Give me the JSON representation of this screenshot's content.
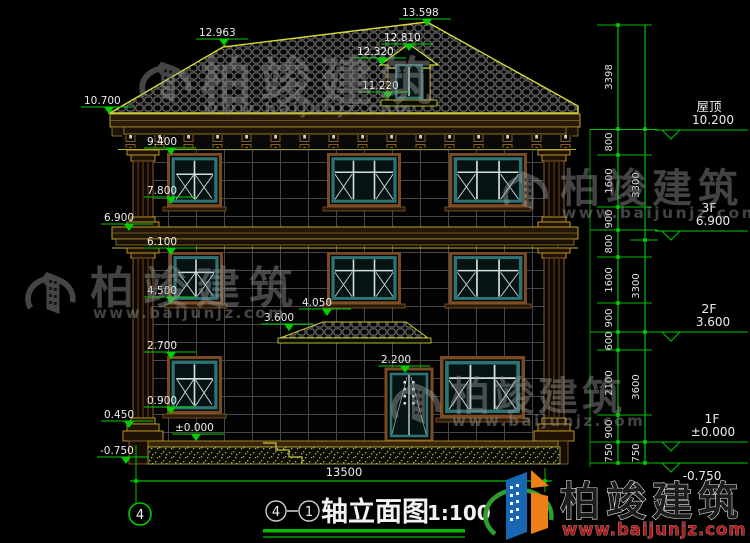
{
  "title": {
    "axis_from": "4",
    "axis_to": "1",
    "text": "轴立面图",
    "scale": "1:100"
  },
  "axis": {
    "left_bubble": "4"
  },
  "watermark": {
    "brand": "柏竣建筑",
    "url": "www.baijunjz.com"
  },
  "logo": {
    "brand": "柏竣建筑",
    "url": "www.baijunjz.com"
  },
  "elevations": {
    "roof_peak": "13.598",
    "left_ridge": "12.963",
    "dormer_ridge": "12.810",
    "dormer_eave": "12.320",
    "dormer_base": "11.220",
    "main_eave": "10.700",
    "f3_window_top": "9.400",
    "f3_window_sill": "7.800",
    "f3_floor": "6.900",
    "f2_window_top": "6.100",
    "f2_window_sill": "4.500",
    "canopy_top": "4.050",
    "canopy_eave": "3.600",
    "f1_window_top": "2.700",
    "door_top": "2.200",
    "f1_window_sill": "0.900",
    "plinth": "0.450",
    "ground": "±0.000",
    "site_grade": "-0.750"
  },
  "levels": [
    {
      "name": "屋顶",
      "value": "10.200"
    },
    {
      "name": "3F",
      "value": "6.900"
    },
    {
      "name": "2F",
      "value": "3.600"
    },
    {
      "name": "1F",
      "value": "±0.000"
    },
    {
      "name": "",
      "value": "-0.750"
    }
  ],
  "dims": {
    "inner": [
      "3398",
      "800",
      "1600",
      "900",
      "800",
      "1600",
      "900",
      "600",
      "2100",
      "900",
      "750"
    ],
    "outer": [
      "3300",
      "3300",
      "3600",
      "750"
    ],
    "total_width": "13500"
  }
}
